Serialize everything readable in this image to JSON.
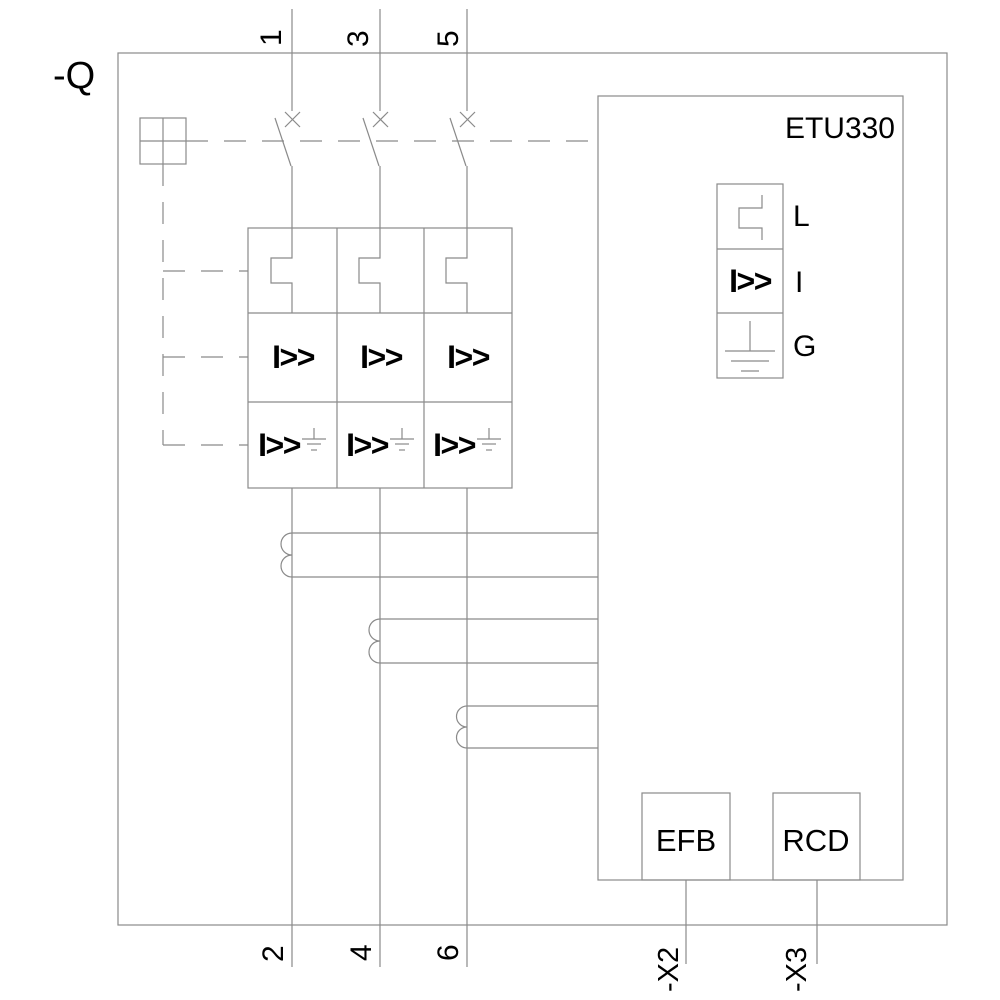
{
  "schematic": {
    "device_designation": "-Q",
    "trip_unit": "ETU330",
    "top_terminals": [
      "1",
      "3",
      "5"
    ],
    "bottom_terminals": [
      "2",
      "4",
      "6"
    ],
    "aux_terminals": [
      "-X2",
      "-X3"
    ],
    "functions": {
      "long_time": "L",
      "instantaneous": "I",
      "ground_fault": "G"
    },
    "instantaneous_symbol": "I>>",
    "modules": {
      "efb": "EFB",
      "rcd": "RCD"
    }
  },
  "colors": {
    "line": "#8a8a8a",
    "text": "#000000",
    "background": "#ffffff"
  }
}
